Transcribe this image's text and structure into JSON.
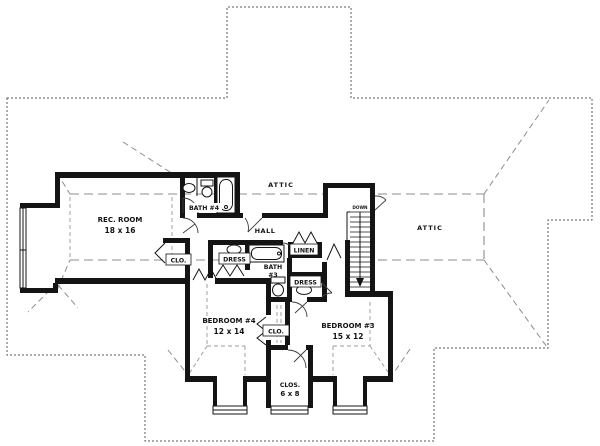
{
  "labels": {
    "rec_room": {
      "name": "REC. ROOM",
      "dims": "18 x 16"
    },
    "bath4": {
      "name": "BATH #4"
    },
    "attic_upper": "ATTIC",
    "attic_right": "ATTIC",
    "hall": "HALL",
    "closet_rec": "CLO.",
    "dress_left": "DRESS",
    "bath3": {
      "line1": "BATH",
      "line2": "#3"
    },
    "linen": "LINEN",
    "dress_right": "DRESS",
    "closet_between": "CLO.",
    "bedroom4": {
      "name": "BEDROOM #4",
      "dims": "12 x 14"
    },
    "bedroom3": {
      "name": "BEDROOM #3",
      "dims": "15 x 12"
    },
    "closet_bottom": {
      "name": "CLOS.",
      "dims": "6 x 8"
    },
    "stair": {
      "direction": "DOWN"
    }
  },
  "colors": {
    "wall": "#141414",
    "roof_outline": "#5a5a5a",
    "ridge": "#8c8c8c",
    "ceiling_dash": "#999999",
    "door": "#3c3c3c",
    "background": "#ffffff"
  }
}
